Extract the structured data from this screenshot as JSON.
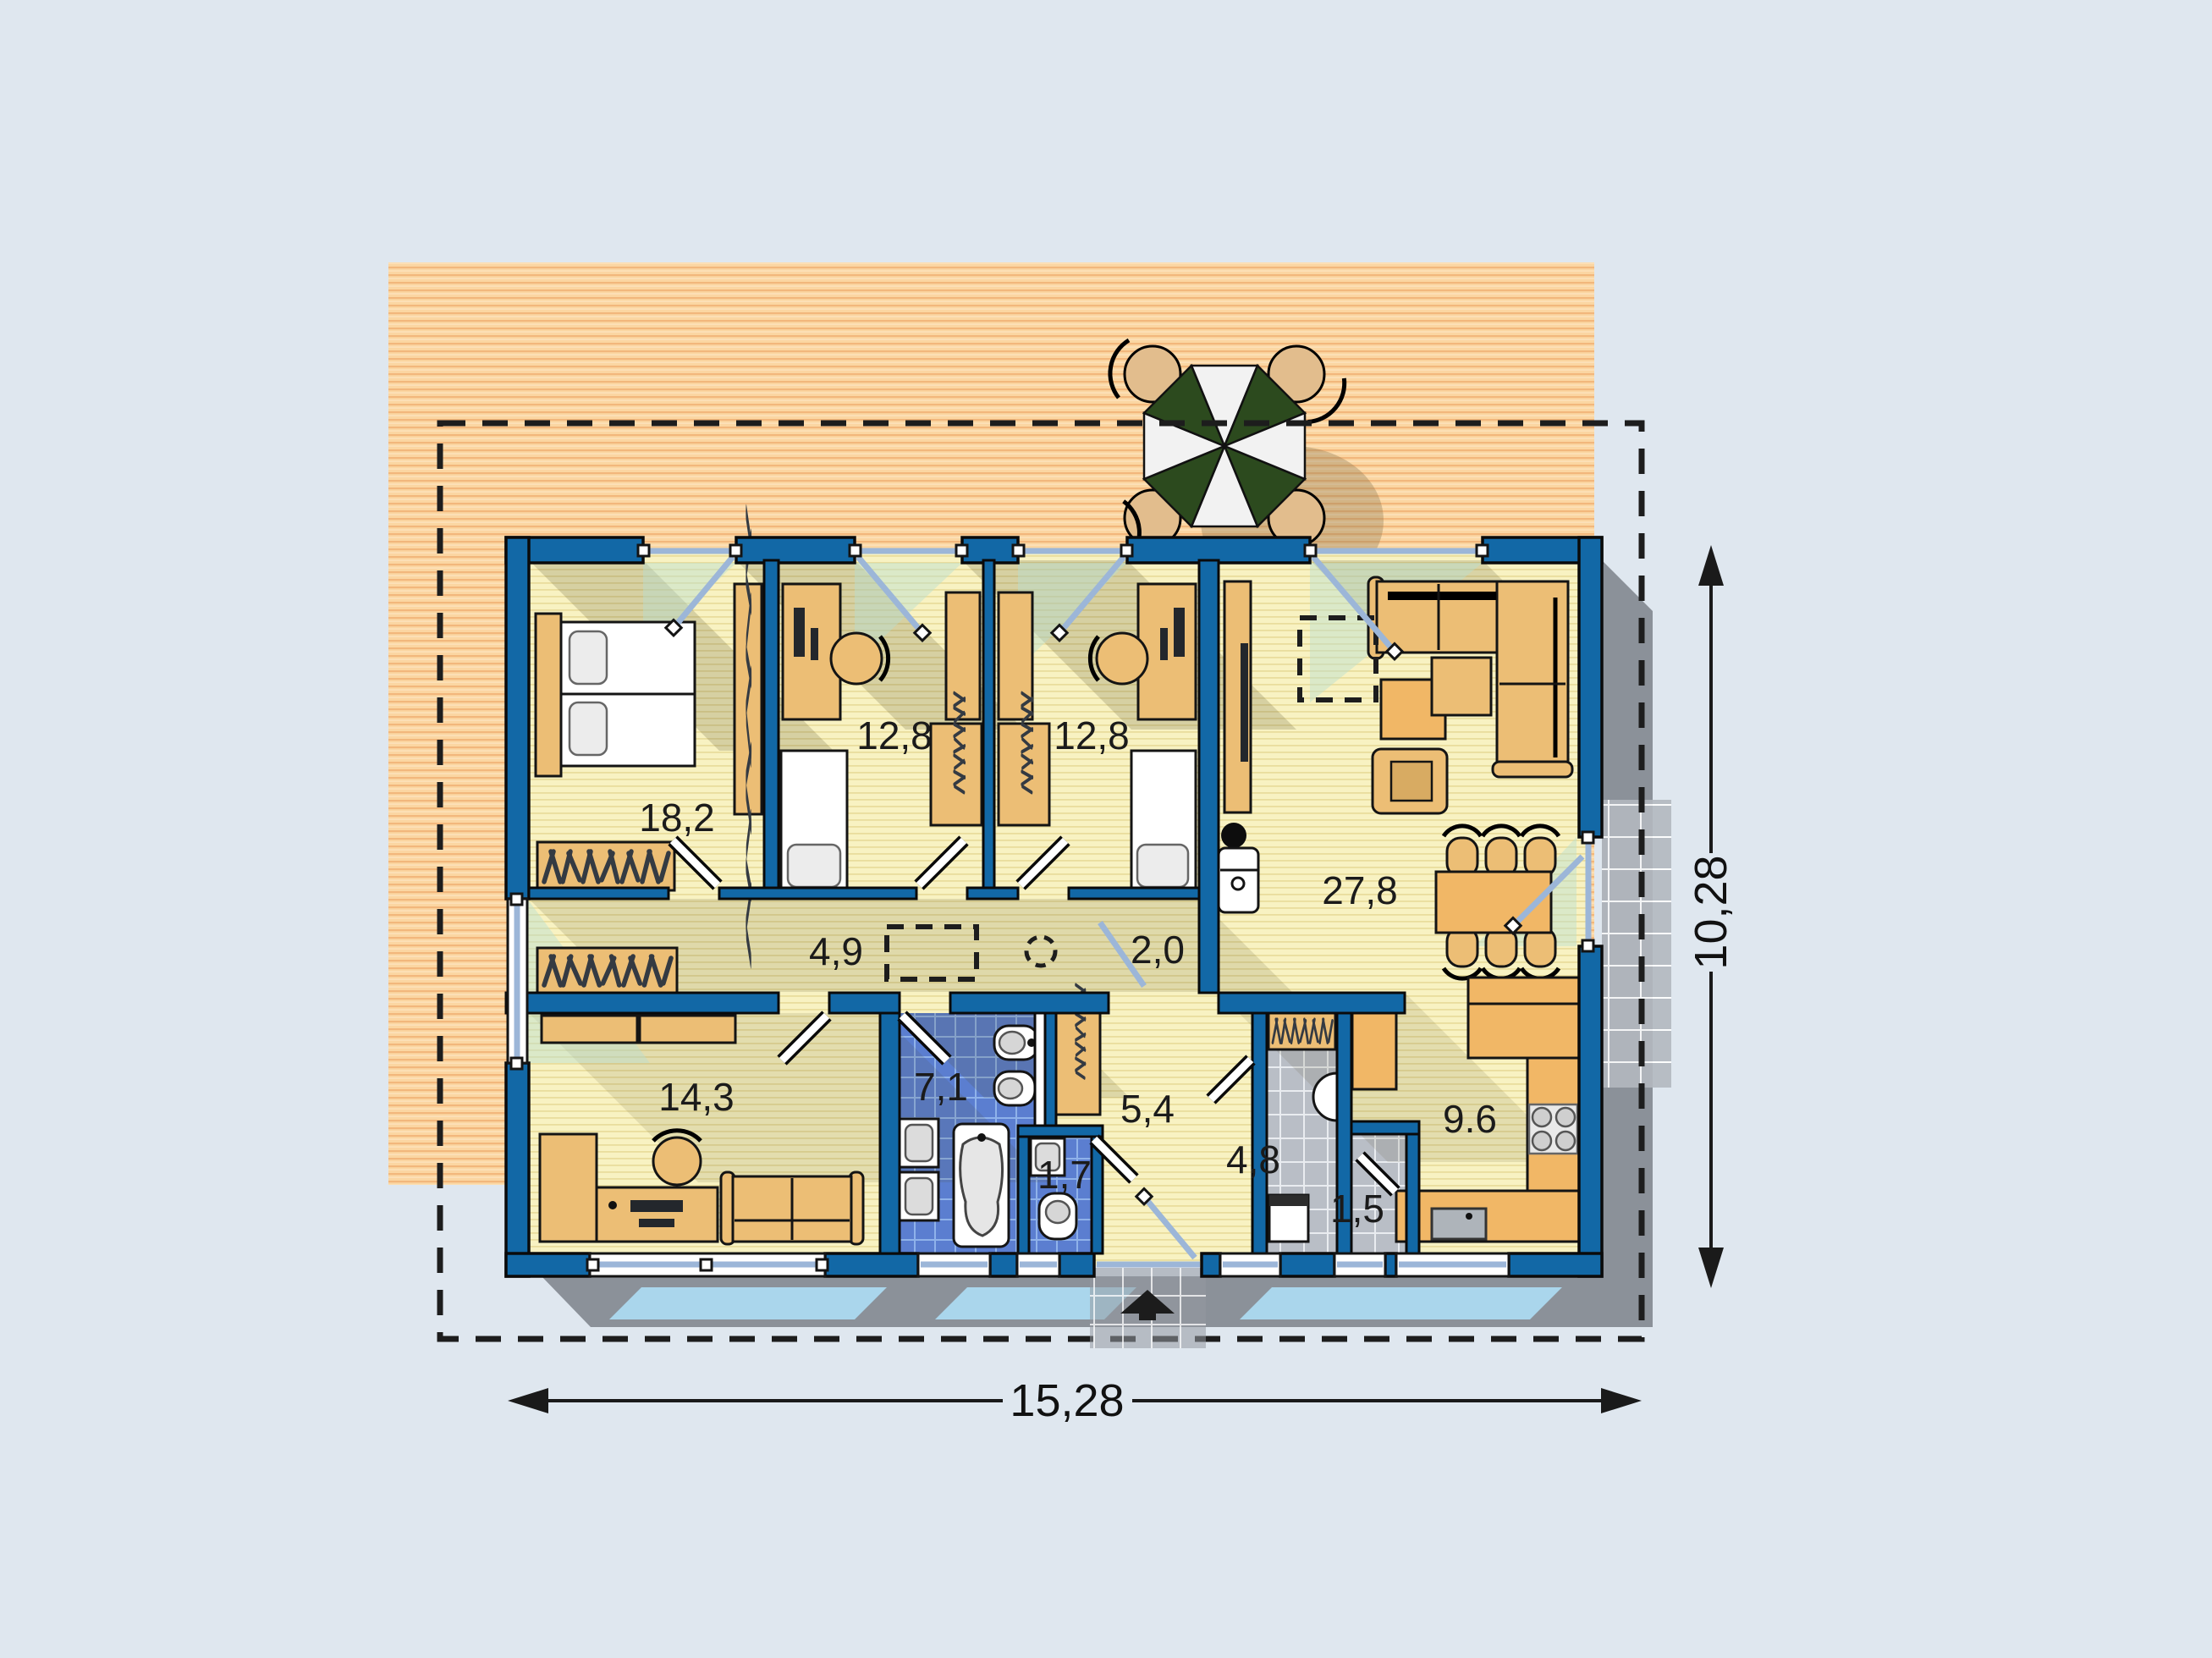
{
  "plan": {
    "rooms": [
      {
        "id": "bedroom",
        "area": "18,2"
      },
      {
        "id": "kids-room-1",
        "area": "12,8"
      },
      {
        "id": "kids-room-2",
        "area": "12,8"
      },
      {
        "id": "living-room",
        "area": "27,8"
      },
      {
        "id": "hallway",
        "area": "4,9"
      },
      {
        "id": "hall-passage",
        "area": "2,0"
      },
      {
        "id": "study",
        "area": "14,3"
      },
      {
        "id": "bathroom",
        "area": "7,1"
      },
      {
        "id": "wc",
        "area": "1,7"
      },
      {
        "id": "entrance-hall",
        "area": "5,4"
      },
      {
        "id": "utility-room",
        "area": "4,8"
      },
      {
        "id": "pantry",
        "area": "1,5"
      },
      {
        "id": "kitchen",
        "area": "9.6"
      }
    ],
    "dimensions": {
      "width": "15,28",
      "height": "10,28"
    },
    "icons": [
      "umbrella-icon",
      "entrance-arrow-icon"
    ],
    "colors": {
      "background": "#dfe7ef",
      "wall": "#1268a6",
      "floor": "#f8f2c2",
      "deck": "#fbd6a2",
      "bath_tile": "#5b7ed0",
      "gray_tile": "#b9bec6",
      "shadow": "#8b9199",
      "umbrella_green": "#2c4a1e",
      "glass": "#9cb6d8"
    }
  }
}
